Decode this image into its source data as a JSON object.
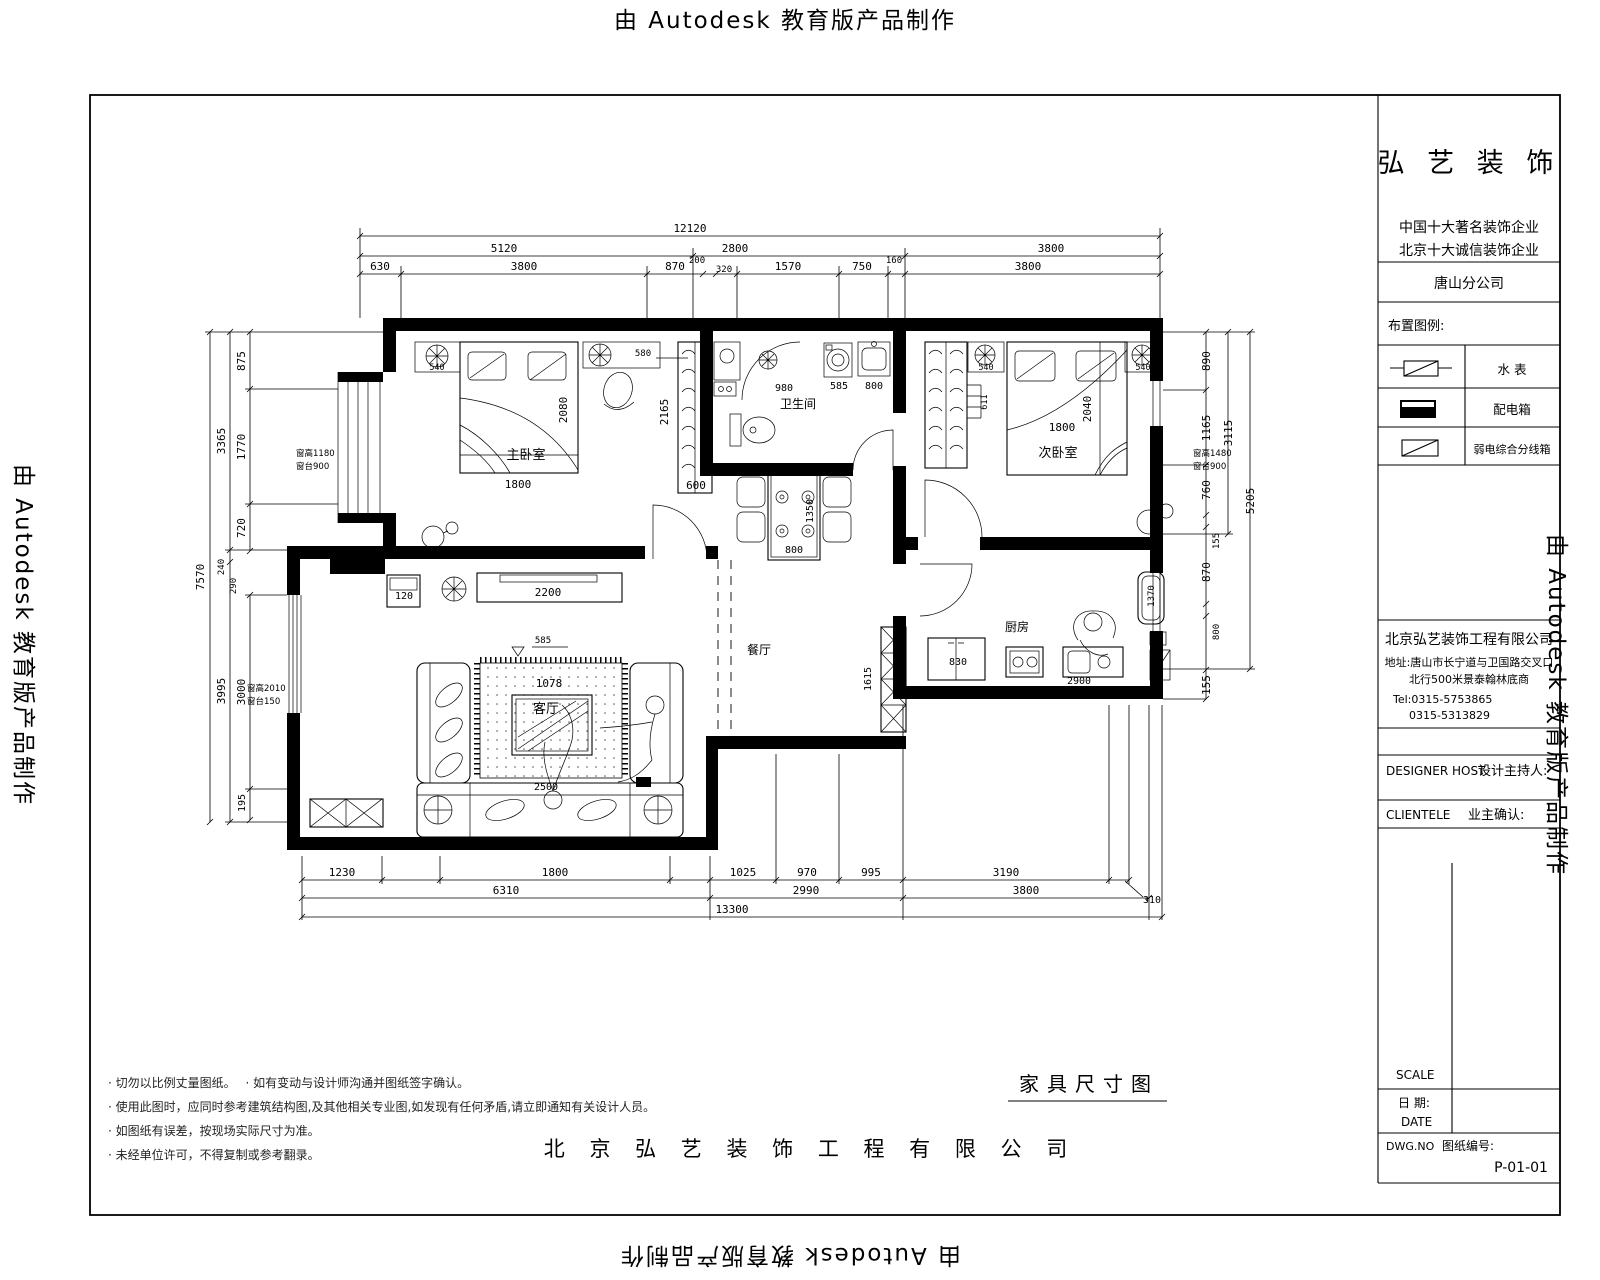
{
  "watermark": "由 Autodesk 教育版产品制作",
  "caption": "家具尺寸图",
  "footer": "北 京 弘 艺 装 饰 工 程 有 限 公 司",
  "notes": [
    "· 切勿以比例丈量图纸。　 · 如有变动与设计师沟通并图纸签字确认。",
    "· 使用此图时，应同时参考建筑结构图,及其他相关专业图,如发现有任何矛盾,请立即通知有关设计人员。",
    "· 如图纸有误差，按现场实际尺寸为准。",
    "· 未经单位许可，不得复制或参考翻录。"
  ],
  "rooms": {
    "master": "主卧室",
    "second": "次卧室",
    "bath": "卫生间",
    "living": "客厅",
    "dining": "餐厅",
    "kitchen": "厨房"
  },
  "titleblock": {
    "brand": "弘 艺 装 饰",
    "slogan1": "中国十大著名装饰企业",
    "slogan2": "北京十大诚信装饰企业",
    "branch": "唐山分公司",
    "legend_title": "布置图例:",
    "legend": [
      "水  表",
      "配电箱",
      "弱电综合分线箱"
    ],
    "company": "北京弘艺装饰工程有限公司",
    "addr1": "地址:唐山市长宁道与卫国路交叉口",
    "addr2": "北行500米景泰翰林底商",
    "tel1": "Tel:0315-5753865",
    "tel2": "0315-5313829",
    "designer_en": "DESIGNER HOST",
    "designer_cn": "设计主持人:",
    "client_en": "CLIENTELE",
    "client_cn": "业主确认:",
    "scale": "SCALE",
    "date_cn": "日  期:",
    "date_en": "DATE",
    "dwg_en": "DWG.NO",
    "dwg_cn": "图纸编号:",
    "dwg_no": "P-01-01"
  },
  "dims": {
    "overall_top": "12120",
    "top2": [
      "5120",
      "2800",
      "3800"
    ],
    "top3": [
      "630",
      "3800",
      "870",
      "200",
      "320",
      "1570",
      "750",
      "160",
      "3800"
    ],
    "left": [
      "7570",
      "3365",
      "3995",
      "875",
      "1770",
      "720",
      "240",
      "290",
      "3000",
      "195"
    ],
    "right": [
      "890",
      "1165",
      "760",
      "155",
      "870",
      "800",
      "155",
      "3115",
      "5205"
    ],
    "bottom1": [
      "1230",
      "1800",
      "1025",
      "970",
      "995",
      "3190",
      "310"
    ],
    "bottom2": [
      "6310",
      "2990",
      "3800"
    ],
    "bottom3": "13300"
  },
  "fdims": {
    "bed1_w": "1800",
    "bed1_l": "2080",
    "ward1_d": "2165",
    "ward1_w": "600",
    "plant1": "540",
    "desk": "580",
    "shower": "980",
    "washer": "585",
    "basin": "800",
    "table_w": "800",
    "table_l": "1350",
    "shelf": "611",
    "plant2": "540",
    "plant3": "540",
    "bed2_w": "1800",
    "bed2_l": "2040",
    "hall": "1615",
    "fridge": "830",
    "counter": "2900",
    "sink": "1370",
    "tvcab": "2200",
    "cab": "120",
    "rug": "1078",
    "sofa": "2500",
    "elev": "585"
  },
  "win": {
    "w1a": "窗高1180",
    "w1b": "窗台900",
    "w2a": "窗高2010",
    "w2b": "窗台150",
    "w3a": "窗高1480",
    "w3b": "窗台900"
  }
}
